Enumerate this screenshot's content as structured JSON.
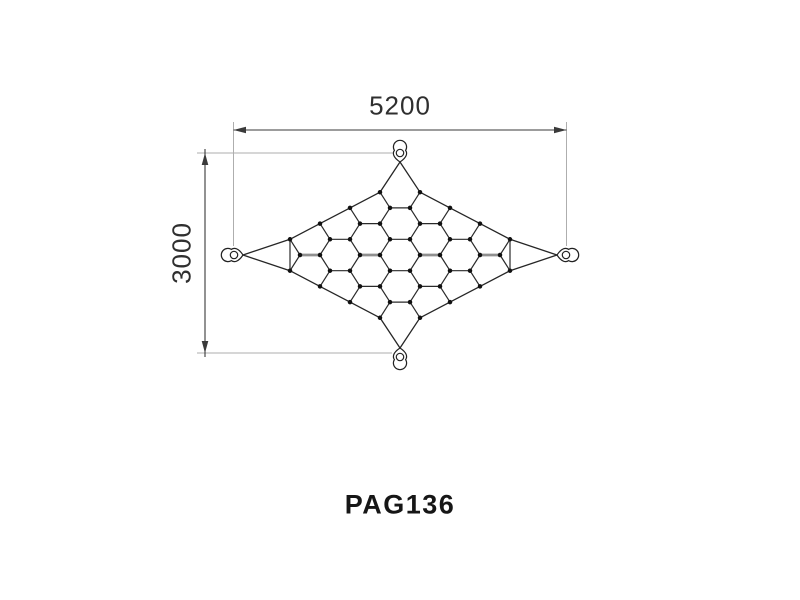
{
  "title": {
    "label": "PAG136"
  },
  "dimensions": {
    "width_label": "5200",
    "height_label": "3000"
  },
  "colors": {
    "background": "#ffffff",
    "mesh_line": "#2a2a2a",
    "rope_line": "#262626",
    "thick_bond": "#8f8f8f",
    "dot": "#111111",
    "dim_line": "#3a3a3a",
    "ext_line": "#aeaeae",
    "label_text": "#2f2f2f",
    "title_text": "#161616"
  },
  "net": {
    "cx": 400,
    "cy": 255,
    "half_width": 157,
    "half_height": 92,
    "hex_side": 20,
    "hex_half_height": 15.7,
    "concavity": -0.3,
    "clip_threshold": 0.85,
    "dot_radius": 2.25,
    "anchors": [
      {
        "id": "top",
        "tip": [
          400,
          162
        ],
        "ring": [
          400,
          153.8
        ],
        "rot": 0
      },
      {
        "id": "right",
        "tip": [
          557,
          255
        ],
        "ring": [
          565.2,
          255
        ],
        "rot": 90
      },
      {
        "id": "bottom",
        "tip": [
          400,
          348
        ],
        "ring": [
          400,
          356.2
        ],
        "rot": 180
      },
      {
        "id": "left",
        "tip": [
          243,
          255
        ],
        "ring": [
          234.8,
          255
        ],
        "rot": -90
      }
    ]
  },
  "dim_geometry": {
    "width_dim": {
      "line": [
        233.5,
        130,
        566.5,
        130
      ],
      "label_center": [
        400,
        105
      ]
    },
    "height_dim": {
      "line": [
        205,
        149,
        205,
        357
      ],
      "label_center": [
        181,
        253
      ]
    },
    "ext_lines": [
      [
        233.5,
        122,
        233.5,
        246
      ],
      [
        566.5,
        122,
        566.5,
        246
      ],
      [
        197,
        153,
        393,
        153
      ],
      [
        197,
        353,
        392,
        353
      ]
    ],
    "arrows": [
      [
        233.5,
        130,
        246,
        126.7,
        246,
        133.3
      ],
      [
        566.5,
        130,
        554,
        126.7,
        554,
        133.3
      ],
      [
        205,
        153,
        201.7,
        165,
        208.3,
        165
      ],
      [
        205,
        353,
        201.7,
        341,
        208.3,
        341
      ]
    ]
  },
  "title_center": [
    400,
    504
  ]
}
